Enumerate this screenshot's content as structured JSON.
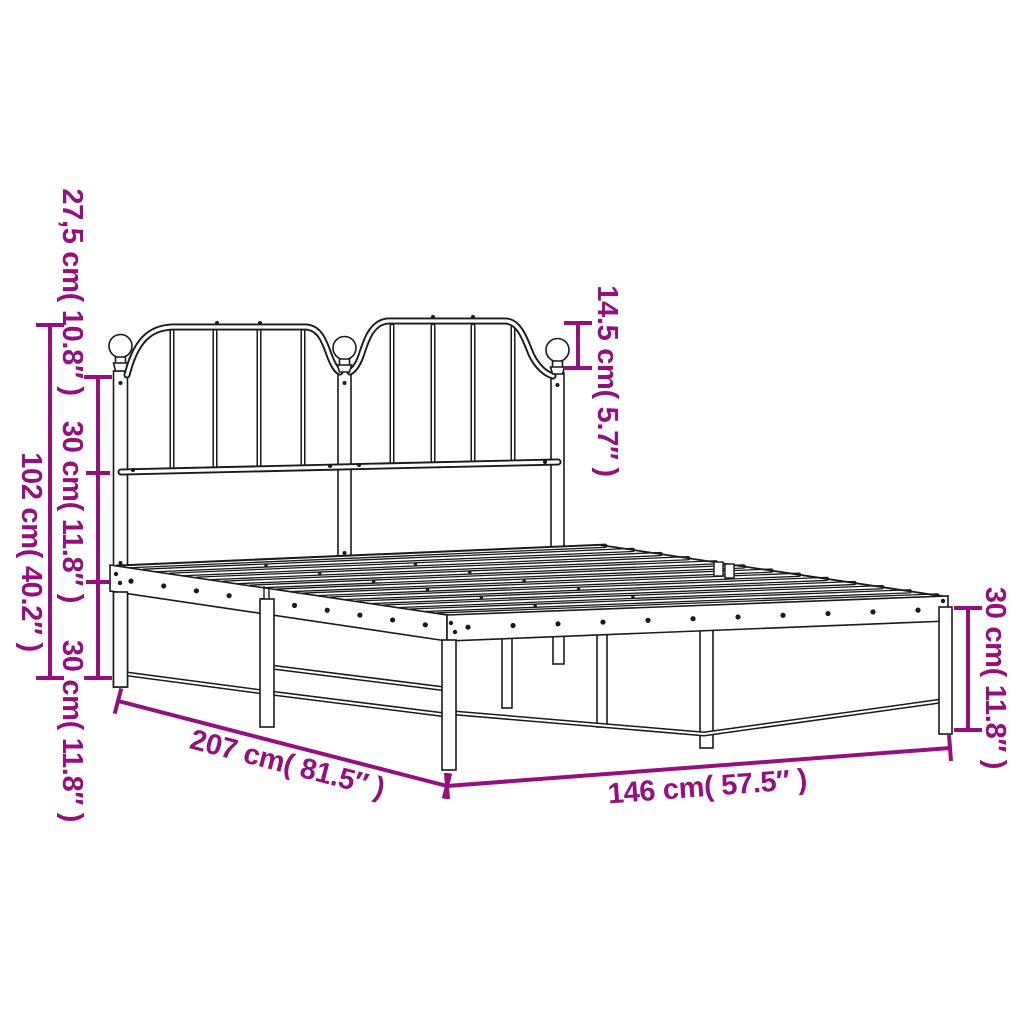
{
  "title": "Metal bed frame with headboard - dimension diagram",
  "colors": {
    "accent": "#93107e",
    "line": "#1a1a1a",
    "background": "#ffffff"
  },
  "dimensions": {
    "headboard_top_section": "27,5 cm( 10.8″ )",
    "headboard_mid_section": "30 cm( 11.8″ )",
    "frame_height_section": "30 cm( 11.8″ )",
    "total_height": "102 cm( 40.2″ )",
    "finial_height": "14.5 cm( 5.7″ )",
    "leg_height": "30 cm( 11.8″ )",
    "bed_length": "207 cm( 81.5″ )",
    "bed_width": "146 cm( 57.5″ )"
  }
}
